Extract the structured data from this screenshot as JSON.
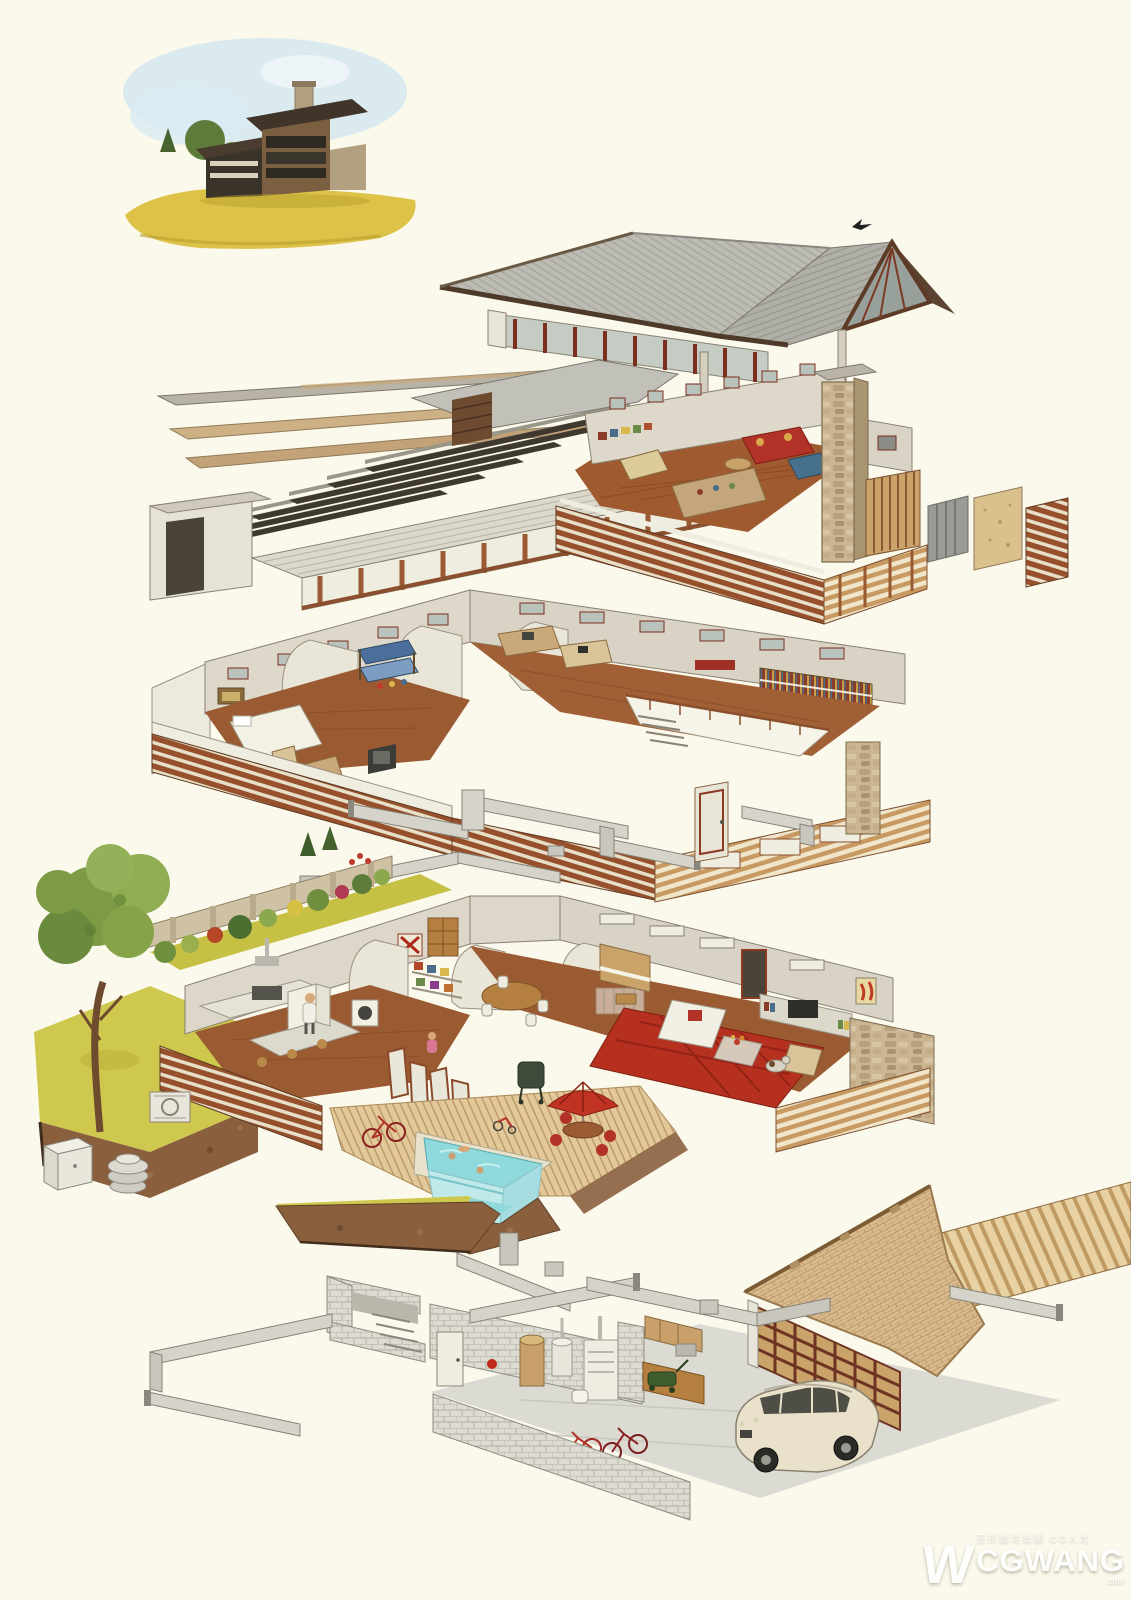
{
  "artwork": {
    "type": "exploded axonometric cutaway illustration",
    "subject": "Prairie-style family house pulled apart into stacked layers, hand-drawn in ink and watercolor on cream paper",
    "background_color": "#fbf9ec"
  },
  "vignette": {
    "name": "finished-house-exterior",
    "description": "Small watercolor of the completed house: low dark roofs, stone chimney, banded windows, trees and yellow lawn under a blue sky wash"
  },
  "layers": [
    {
      "id": "roof",
      "name": "Main roof",
      "features": [
        "gray plank hip roof",
        "right gable with glass wall and dark red mullions",
        "clerestory window band with red-brown posts",
        "dark timber fascia",
        "bird perched on ridge"
      ]
    },
    {
      "id": "upper-floor",
      "name": "Upper floor studio loft",
      "features": [
        "lifted roof decking planks",
        "row of exposed rafters",
        "long clerestory corridor tube",
        "loft room with red sofa and round table",
        "drafting table and workbench",
        "stone chimney shaft",
        "horizontal wood-slat parapets",
        "three wall build-up sample panels: ribbed metal, plywood, wood siding"
      ]
    },
    {
      "id": "bedroom-floor",
      "name": "Bedroom floor",
      "features": [
        "master bedroom with bed, chair, desk and TV",
        "bathroom behind curved cut wall",
        "children's room with blue bunk beds",
        "sewing and hobby desks",
        "library wall of colorful books",
        "stairwell opening with railing and steps",
        "wood-slat band with window strip",
        "stone chimney pier"
      ]
    },
    {
      "id": "services",
      "name": "Heating ducts and doors",
      "features": [
        "galvanized supply ducts with elbows and registers",
        "detached interior door panel"
      ]
    },
    {
      "id": "ground-floor",
      "name": "Ground floor, garden and pool",
      "features": [
        "walled garden with big tree, shrubs and conifers",
        "kitchen with range, island, open refrigerator and figure",
        "laundry washer and toy shelves",
        "dining table with white chairs",
        "upright piano and playpen",
        "living room with white sofa, red rug, coffee table, TV wall and dog",
        "stone fireplace wall",
        "folding glass doors to wood deck",
        "red patio umbrella with table and chairs",
        "barbecue grill, bicycle and tricycle",
        "cutaway swimming pool with swimmers",
        "air-conditioner unit, meter box and septic lid",
        "earth section under the lawn"
      ]
    },
    {
      "id": "basement",
      "name": "Basement utility room and garage",
      "features": [
        "concrete block walls and window well",
        "basement stair",
        "duct network hung below joists",
        "water softener, water heater and furnace",
        "fire extinguisher on wall",
        "workbench with sink, cabinets and mower",
        "wood joist deck strip",
        "herringbone brick forecourt wedge",
        "slatted garage door",
        "cream SUV parked inside",
        "two red bicycles behind low block wall"
      ]
    }
  ],
  "watermark": {
    "logo_letter": "W",
    "brand": "CGWANG",
    "tagline": "王氏教育集团 CG人才",
    "domain": ".com"
  },
  "palette": {
    "paper": "#fbf9ec",
    "roof_gray": "#bcbbb4",
    "timber_dark": "#4d3a28",
    "wood_mid": "#9a5c33",
    "wood_light": "#d9bb8c",
    "stone": "#cbb592",
    "wall": "#dcd7c8",
    "floor": "#9a5a32",
    "lawn": "#cfc84e",
    "foliage": "#7d9a45",
    "earth": "#8a5f3e",
    "pool": "#8fd8dc",
    "accent_red": "#b23228",
    "rug_red": "#b5301f",
    "concrete": "#dddcd2",
    "duct": "#d6d4ca",
    "car_cream": "#e9e1c9"
  }
}
